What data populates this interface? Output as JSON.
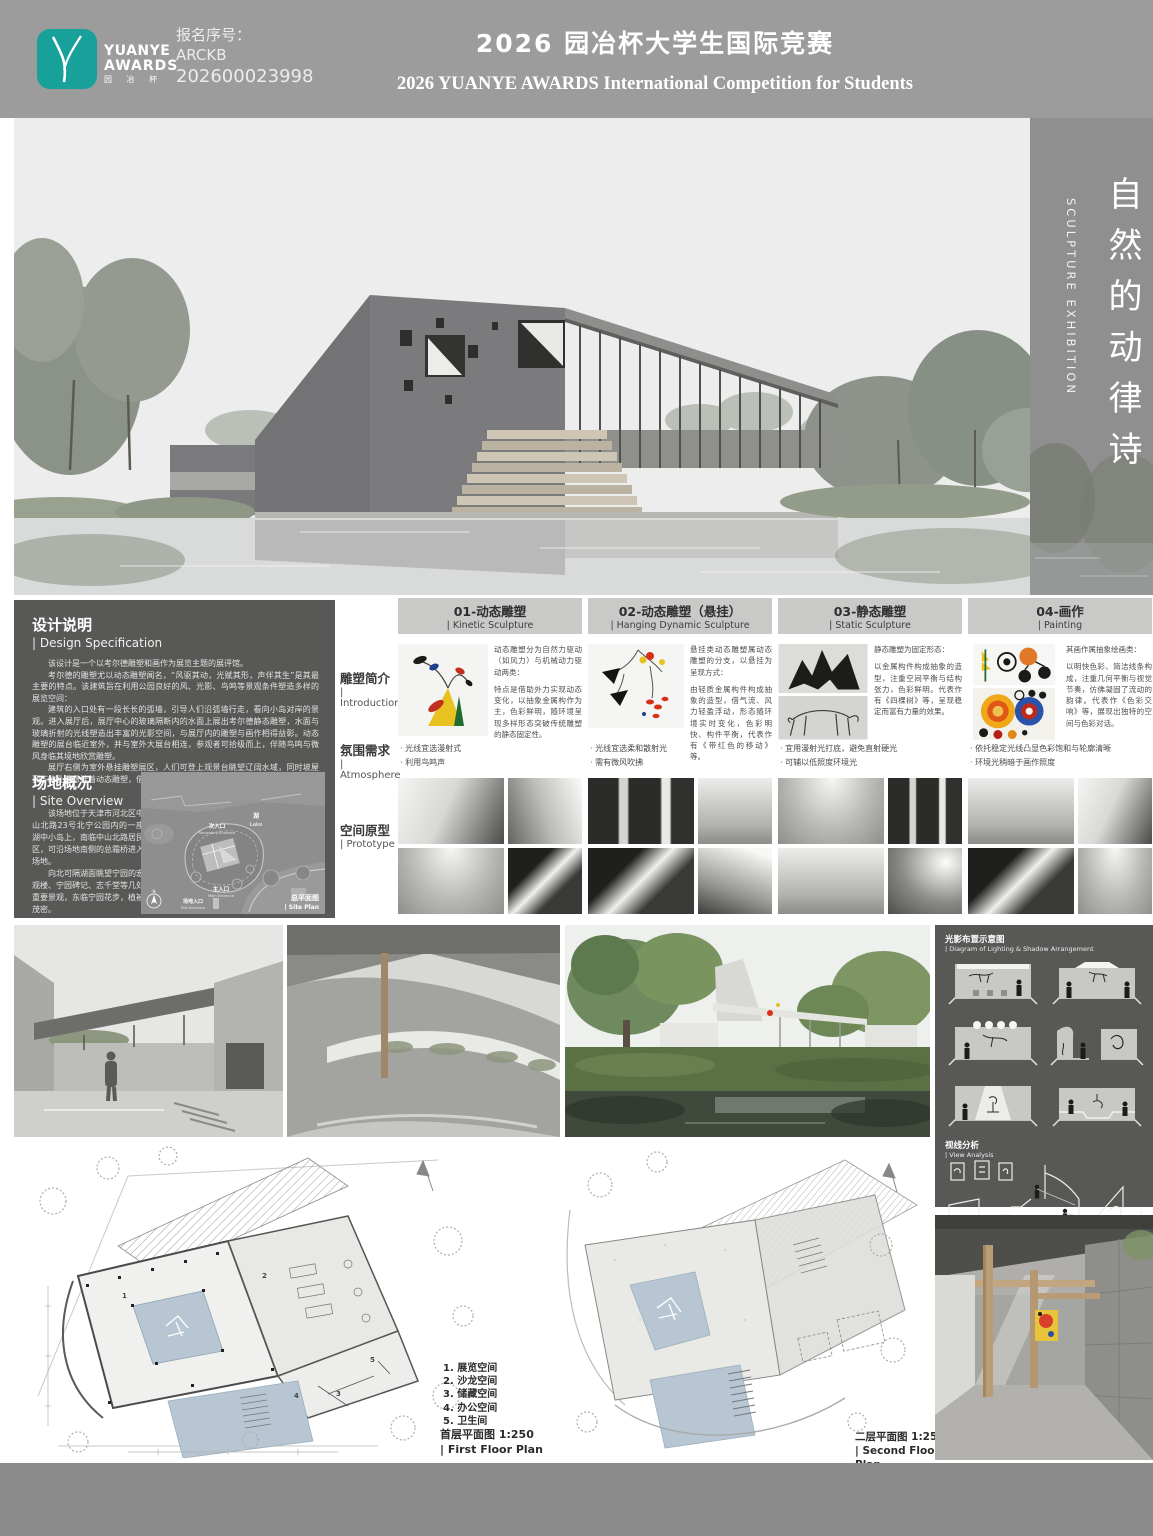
{
  "palette": {
    "accent_teal": "#18a09b",
    "header_gray": "#9c9c9c",
    "sidebar_gray": "#8f8f8f",
    "panel_dark": "#585856",
    "bar_gray": "#c9c9c8",
    "pool_blue": "#b7c6d2"
  },
  "header": {
    "brand_line1": "YUANYE",
    "brand_line2": "AWARDS",
    "brand_cn": "园 冶 杯",
    "entry_label": "报名序号：",
    "entry_code": "ARCKB",
    "entry_number": "202600023998",
    "title_cn": "2026 园冶杯大学生国际竞赛",
    "title_en": "2026 YUANYE AWARDS International Competition for  Students"
  },
  "sidebar": {
    "title_cn": "自然的动律诗",
    "title_en": "SCULPTURE  EXHIBITION",
    "artist_line1": "ALEXANDER",
    "artist_line2": "CALDER"
  },
  "design_spec": {
    "heading_cn": "设计说明",
    "heading_en": "| Design Specification",
    "p1": "该设计是一个以考尔德雕塑和画作为展览主题的展评馆。",
    "p2": "考尔德的雕塑尤以动态雕塑闻名，“风驱其动，光赋其形，声伴其生”是其最主要的特点。该建筑旨在利用公园良好的风、光影、鸟鸣等景观条件塑造多样的展览空间：",
    "p3": "建筑的入口处有一段长长的弧墙，引导人们沿弧墙行走，看向小岛对岸的景观。进入展厅后，展厅中心的玻璃隔断内的水面上展出考尔德静态雕塑，水面与玻璃折射的光线塑造出丰富的光影空间，与展厅内的雕塑与画作相得益彰。动态雕塑的展台临近室外，并与室外大展台相连，参观者可拾级而上，伴随鸟鸣与微风身临其境地欣赏雕塑。",
    "p4": "展厅右侧为室外悬挂雕塑展区，人们可登上观景台眺望辽阔水域，同时坡屋顶下的孔洞悬挂着动态雕塑，借助风力与光影效果形成独特观赏体验。"
  },
  "site_overview": {
    "heading_cn": "场地概况",
    "heading_en": "| Site Overview",
    "p1": "该场地位于天津市河北区中山北路23号北宁公园内的一座湖中小岛上，南临中山北路居民区，可沿场地南侧的总霜桥进入场地。",
    "p2": "向北可隔湖面眺望宁园的宏观楼、宁园碑记、志千堂等几处重要景观，东临宁园花步，植被茂密。",
    "map": {
      "lake_cn": "湖",
      "lake_en": "Lake",
      "secondary_cn": "次入口",
      "secondary_en": "Secondary Entrance",
      "main_cn": "主入口",
      "main_en": "Main Entrance",
      "site_cn": "场地入口",
      "site_en": "Site Entrance",
      "caption_cn": "总平面图",
      "caption_en": "| Site Plan",
      "north": "N"
    }
  },
  "matrix": {
    "row_labels": [
      {
        "cn": "雕塑简介",
        "en": "| Introduction"
      },
      {
        "cn": "氛围需求",
        "en": "| Atmosphere"
      },
      {
        "cn": "空间原型",
        "en": "| Prototype"
      }
    ],
    "columns": [
      {
        "header_cn": "01-动态雕塑",
        "header_en": "| Kinetic Sculpture",
        "intro": [
          "动态雕塑分为自然力驱动（如风力）与机械动力驱动两类：",
          "特点是借助外力实现动态变化，以抽象金属构作为主，色彩鲜明，随环境呈现多样形态突破传统雕塑的静态固定性。"
        ],
        "atmosphere": [
          "· 光线宜选漫射式",
          "· 利用鸟鸣声"
        ]
      },
      {
        "header_cn": "02-动态雕塑（悬挂）",
        "header_en": "| Hanging Dynamic Sculpture",
        "intro": [
          "悬挂类动态雕塑属动态雕塑的分支，以悬挂为呈现方式：",
          "由轻质金属构件构成抽象的造型，借气流、风力轻盈浮动，形态随环境实时变化，色彩明快、构件平衡，代表作有《带红色的移动》等。"
        ],
        "atmosphere": [
          "· 光线宜选柔和散射光",
          "· 需有微风吹拂"
        ]
      },
      {
        "header_cn": "03-静态雕塑",
        "header_en": "| Static Sculpture",
        "intro": [
          "静态雕塑为固定形态：",
          "以金属构件构成抽象的造型，注重空间平衡与结构张力，色彩鲜明。代表作有《四棵树》等，呈现稳定而富有力量的效果。"
        ],
        "atmosphere": [
          "· 宜用漫射光打底，避免直射硬光",
          "· 可辅以低照度环境光"
        ]
      },
      {
        "header_cn": "04-画作",
        "header_en": "| Painting",
        "intro": [
          "其画作属抽象绘画类：",
          "以明快色彩、简洁线条构成，注重几何平衡与视觉节奏，仿佛凝固了流动的韵律。代表作《色彩交响》等，展现出独特的空间与色彩对话。"
        ],
        "atmosphere": [
          "· 依托稳定光线凸显色彩饱和与轮廓清晰",
          "· 环境光稍暗于画作照度"
        ]
      }
    ]
  },
  "lighting_panel": {
    "heading1_cn": "光影布置示意图",
    "heading1_en": "| Diagram of Lighting & Shadow Arrangement",
    "heading2_cn": "视线分析",
    "heading2_en": "| View Analysis"
  },
  "plans": {
    "legend": [
      "1. 展览空间",
      "2. 沙龙空间",
      "3. 储藏空间",
      "4. 办公空间",
      "5. 卫生间"
    ],
    "first_caption_line1": "首层平面图 1:250",
    "first_caption_line2": "| First Floor Plan",
    "second_caption_line1": "二层平面图 1:250",
    "second_caption_line2": "| Second Floor Plan"
  }
}
